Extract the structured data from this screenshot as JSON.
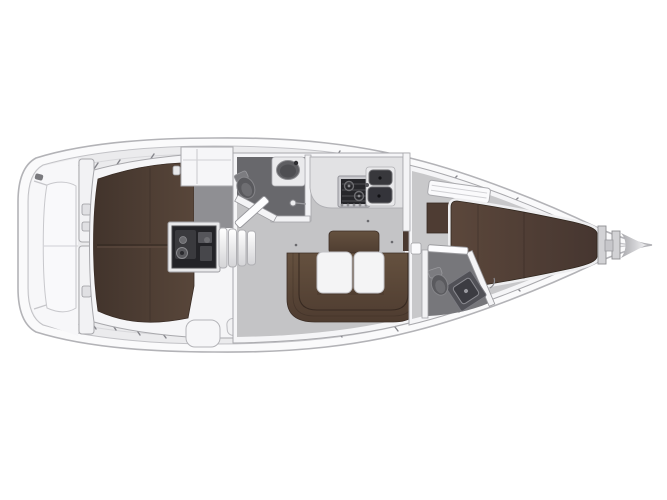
{
  "page": {
    "background": "#ffffff"
  },
  "diagram": {
    "type": "yacht-floor-plan",
    "subject": "Sailing yacht interior layout plan, top view, bow pointing right",
    "palette": {
      "background": "#ffffff",
      "hull_outline": "#b3b3b7",
      "deck": "#ebebed",
      "wall_white": "#f5f5f7",
      "cabin_floor": "#c4c4c6",
      "head_floor": "#68686c",
      "upholstery_dark": "#47372e",
      "upholstery_mid": "#5b4838",
      "table_white": "#f4f4f5",
      "engine_dark": "#232327"
    },
    "compartments": [
      {
        "id": "hull",
        "label": "Hull and side decks"
      },
      {
        "id": "stern-platform",
        "label": "Stern platform and transom lockers"
      },
      {
        "id": "aft-cabin-port",
        "label": "Port aft double cabin"
      },
      {
        "id": "aft-cabin-starboard",
        "label": "Starboard aft double cabin"
      },
      {
        "id": "engine-compartment",
        "label": "Engine compartment under companionway"
      },
      {
        "id": "companionway",
        "label": "Companionway steps"
      },
      {
        "id": "aft-head",
        "label": "Aft head with toilet and washbasin"
      },
      {
        "id": "galley",
        "label": "Galley with two-burner stove and double sink"
      },
      {
        "id": "salon",
        "label": "Salon with U-shaped settee and folding table"
      },
      {
        "id": "forward-head",
        "label": "Forward head with toilet and shower"
      },
      {
        "id": "forward-cabin",
        "label": "Forward cabin with V-berth"
      },
      {
        "id": "anchor-locker",
        "label": "Bow anchor locker"
      }
    ],
    "fixtures": [
      "toilet",
      "washbasin",
      "shower-module",
      "two-burner-stove",
      "double-sink",
      "folding-table",
      "u-shaped-settee",
      "companionway-steps",
      "engine",
      "double-berth",
      "v-berth",
      "wardrobe",
      "anchor-locker",
      "stanchions"
    ]
  }
}
